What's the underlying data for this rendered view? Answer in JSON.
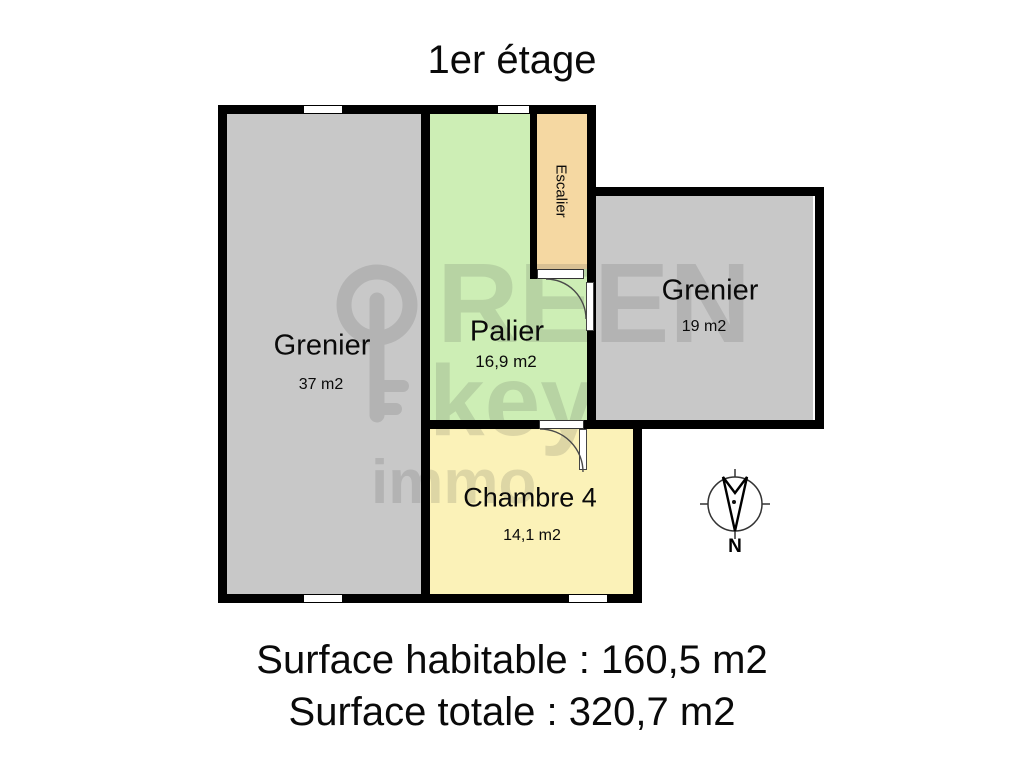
{
  "title": "1er étage",
  "rooms": [
    {
      "name": "grenier-left",
      "label": "Grenier",
      "area": "37 m2"
    },
    {
      "name": "palier",
      "label": "Palier",
      "area": "16,9 m2"
    },
    {
      "name": "escalier",
      "label": "Escalier"
    },
    {
      "name": "grenier-right",
      "label": "Grenier",
      "area": "19 m2"
    },
    {
      "name": "chambre-4",
      "label": "Chambre 4",
      "area": "14,1 m2"
    }
  ],
  "footer": {
    "line1": "Surface habitable : 160,5 m2",
    "line2": "Surface totale : 320,7 m2"
  },
  "compass": {
    "label": "N"
  },
  "watermark": {
    "part1": "REEN",
    "part2": "key",
    "part3": "immo"
  },
  "colors": {
    "wall": "#000000",
    "grenier": "#c8c8c8",
    "palier": "#cdeeb5",
    "escalier": "#f5d8a2",
    "chambre": "#fbf2b8",
    "watermark": "#4a4a4a",
    "doorarc": "#4a4a4a"
  }
}
